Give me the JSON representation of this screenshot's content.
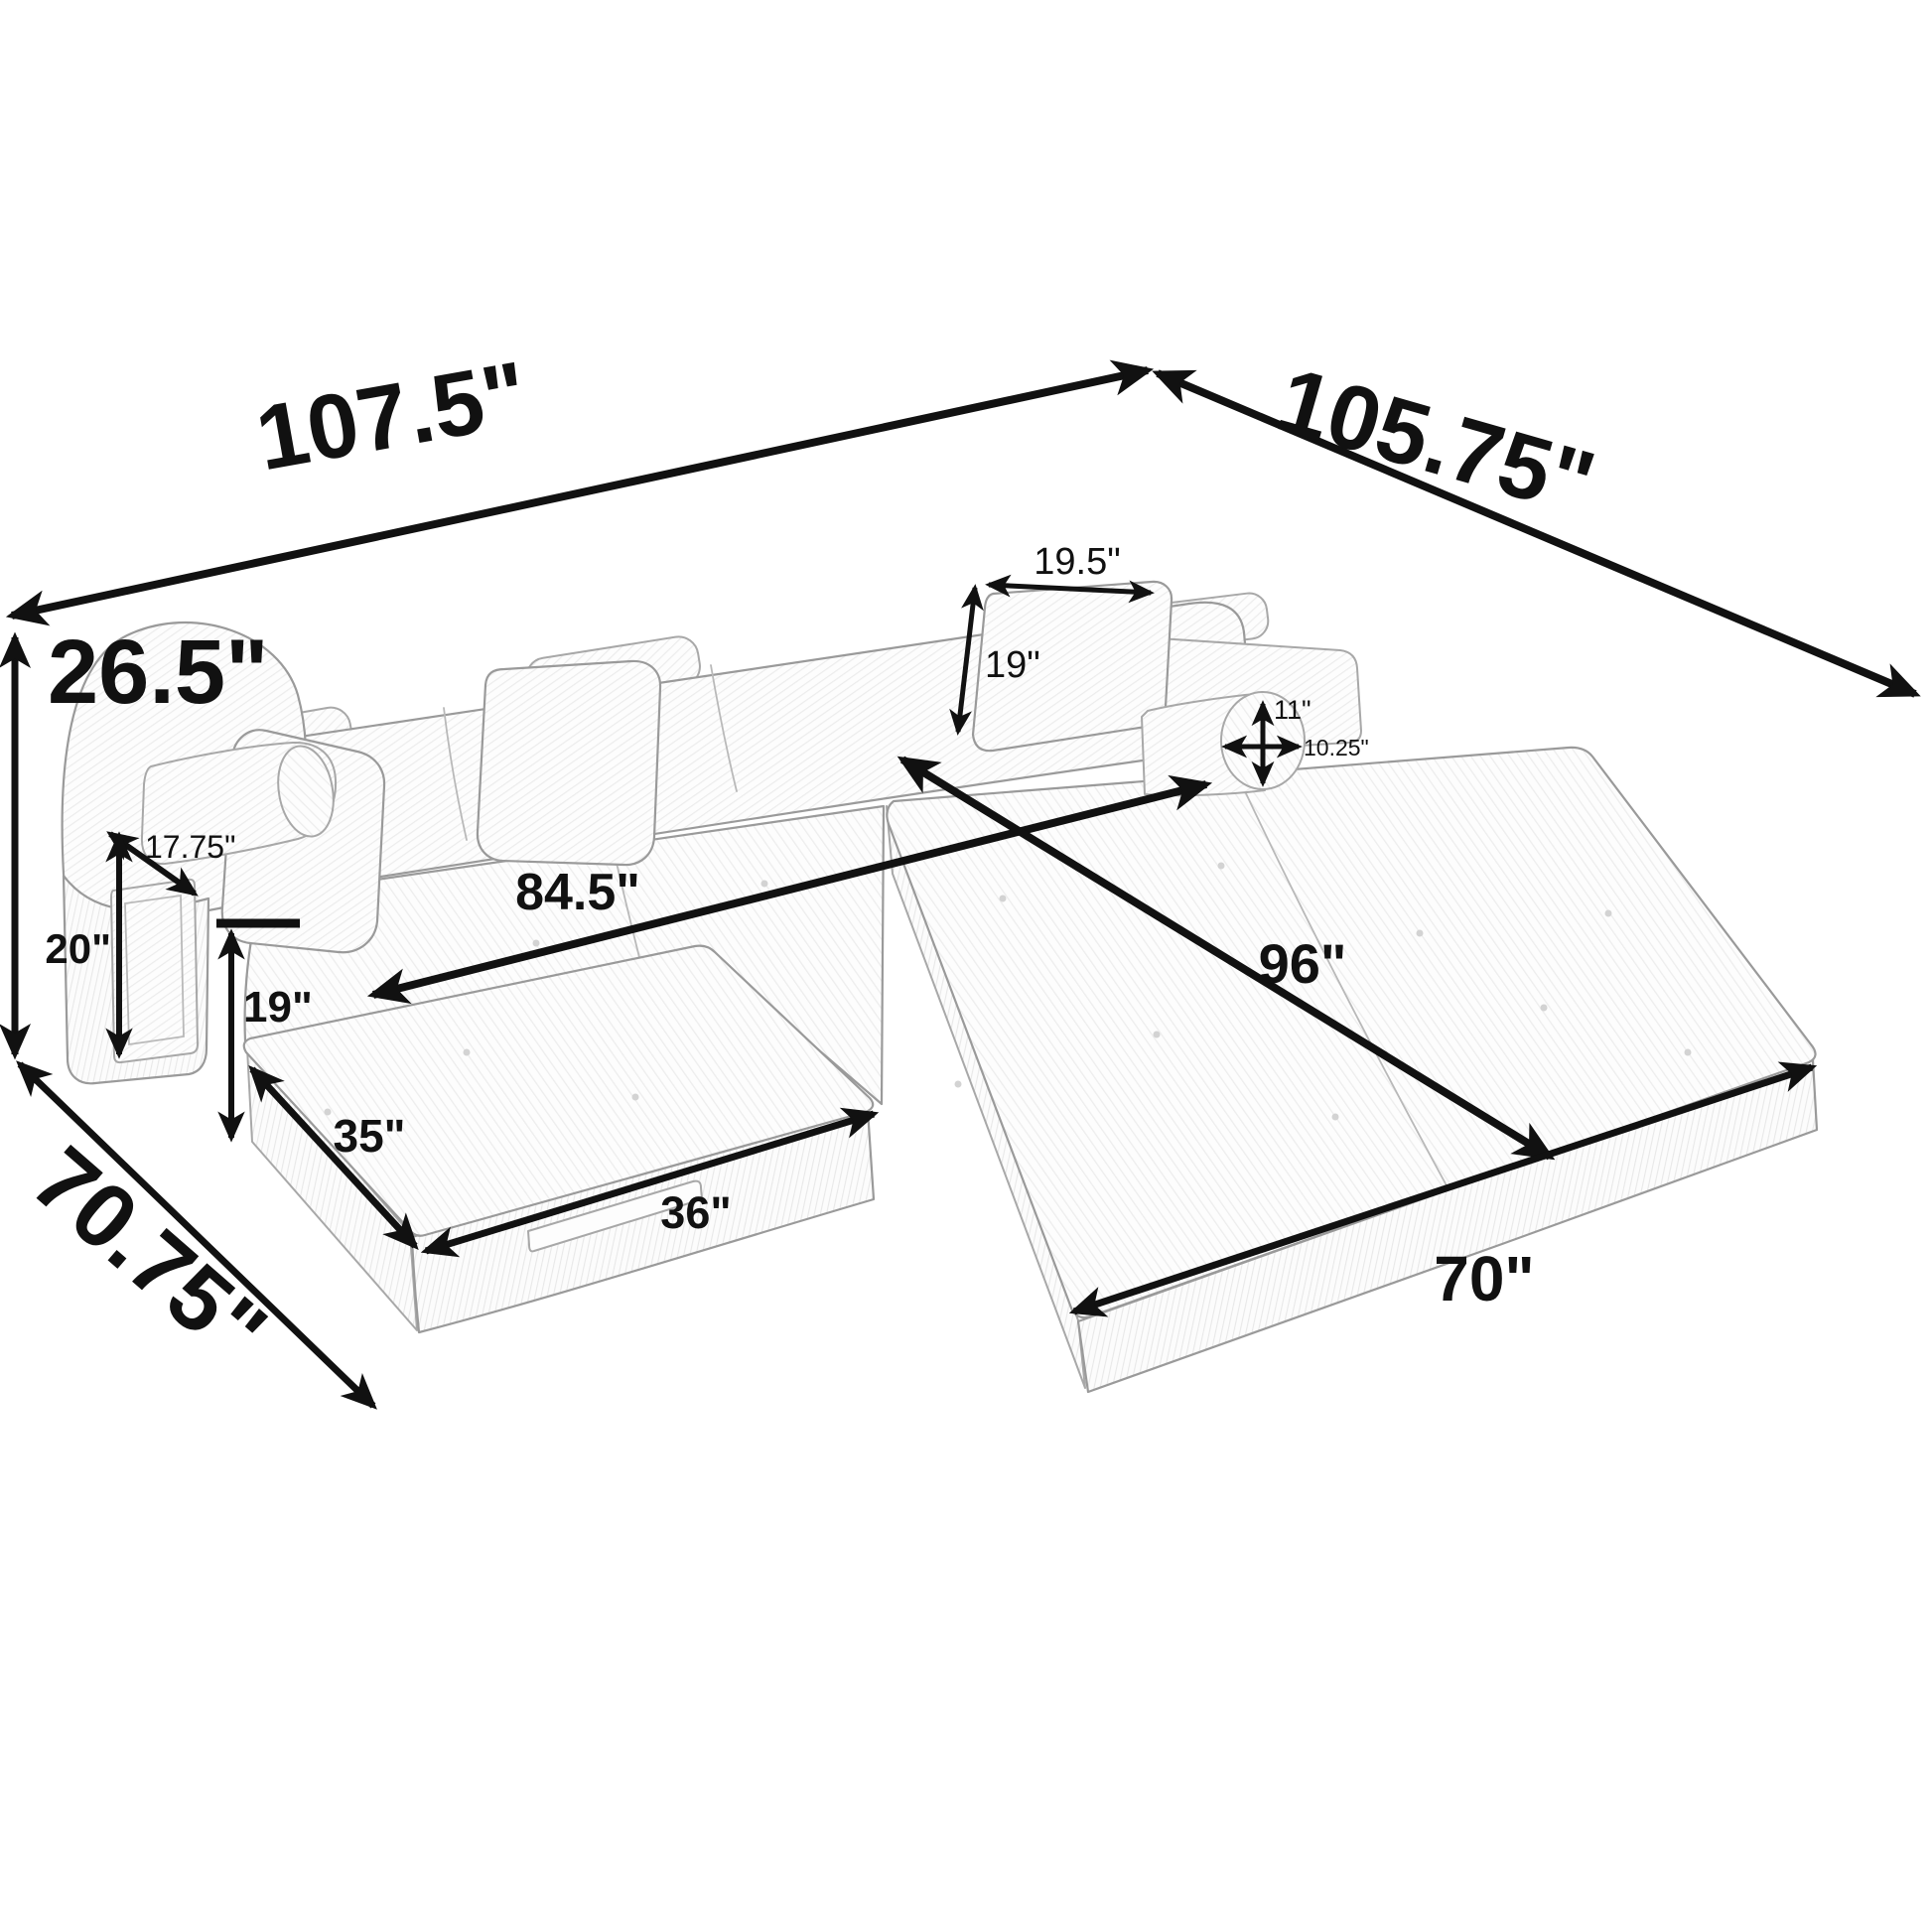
{
  "colors": {
    "background": "#ffffff",
    "arrow": "#111111",
    "sketch_line": "#9a9a9a"
  },
  "dimensions": {
    "overall_width": "107.5\"",
    "overall_depth": "105.75\"",
    "overall_height": "26.5\"",
    "chaise_depth": "70.75\"",
    "back_pillow_width": "19.5\"",
    "back_pillow_height": "19\"",
    "bolster_height": "11\"",
    "bolster_width": "10.25\"",
    "arm_top_width": "17.75\"",
    "arm_height": "20\"",
    "seat_height": "19\"",
    "sofa_seat_width": "84.5\"",
    "bed_length": "96\"",
    "ottoman_depth": "35\"",
    "ottoman_width": "36\"",
    "mattress_front_width": "70\""
  }
}
